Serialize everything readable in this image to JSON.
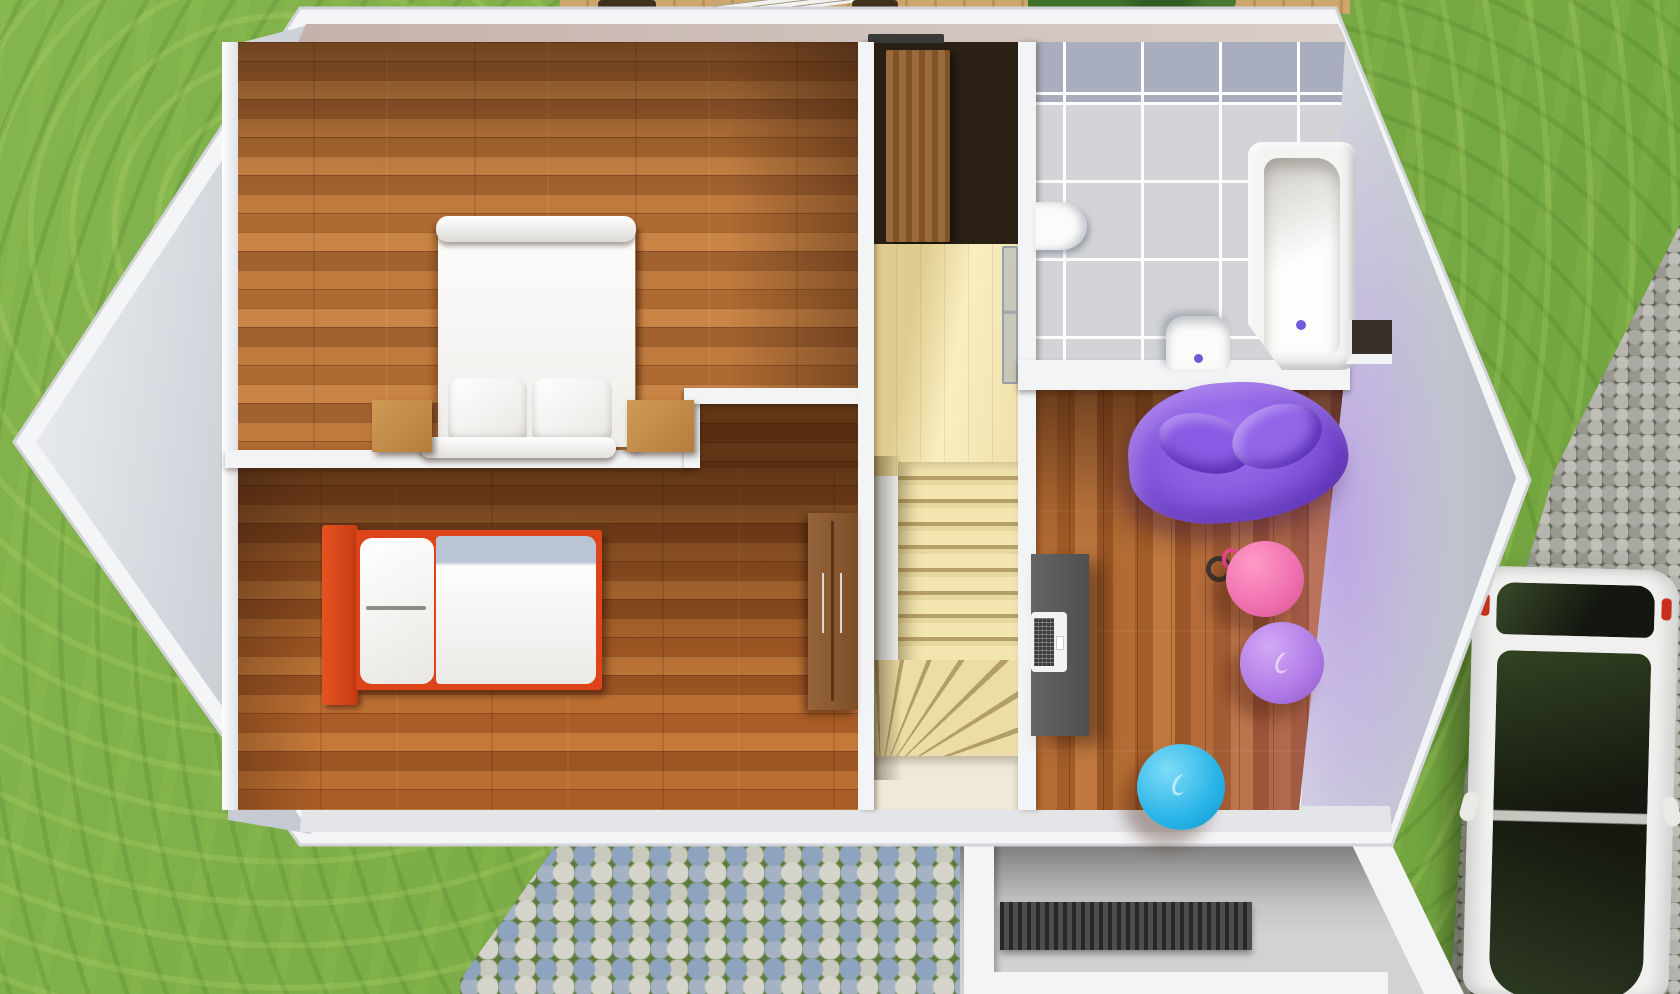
{
  "meta": {
    "title": "3D floor plan render — upper floor, top-down dollhouse view",
    "render_type": "architectural 3D floor plan",
    "visible_text": "none"
  },
  "palette": {
    "grass": "#7aae43",
    "wallWhite": "#f3f4f6",
    "wallFace": "#ccd0d7",
    "tile": "#d3d4d8",
    "tileBand": "#a8aebd",
    "accentPurple": "#6d5bd8",
    "bedRed": "#dd4419",
    "blanket": "#b9c4d4",
    "ballPink": "#ef6fae",
    "ballPurple": "#b07ae6",
    "ballBlue": "#29b4e8",
    "beanBag": "#8357dd",
    "carWhite": "#f0f0ee",
    "carGlass": "#15180f",
    "cobbleBlue": "#8ea3bd",
    "cobbleWhite": "#d6d5cb",
    "driveStone": "#a9a9a3",
    "porch": "#d2d2d0",
    "mat": "#3c3e40",
    "deckWood": "#c9a166",
    "stairWood": "#eddfa9"
  },
  "rooms": [
    {
      "id": "bedroom-master",
      "label": "Bedroom with double bed",
      "furniture": [
        "double bed with white duvet",
        "two pillows",
        "left nightstand",
        "right nightstand"
      ]
    },
    {
      "id": "bedroom-single",
      "label": "Bedroom with single bed",
      "furniture": [
        "single bed with red frame",
        "white pillow",
        "duvet with blue-grey band",
        "wooden dresser"
      ]
    },
    {
      "id": "stair-hall",
      "label": "Staircase hall",
      "furniture": [
        "winder staircase",
        "upper landing",
        "wardrobe closet",
        "glass partition"
      ]
    },
    {
      "id": "bathroom",
      "label": "Bathroom",
      "furniture": [
        "bathtub with purple drain",
        "toilet with purple button",
        "wash basin",
        "grey floor tiles"
      ]
    },
    {
      "id": "playroom",
      "label": "Office / play room",
      "furniture": [
        "dark grey desk",
        "open laptop",
        "purple bean bag",
        "pink gym ball with handle",
        "purple gym ball",
        "blue gym ball"
      ]
    }
  ],
  "exterior": {
    "lawn": "green lawn surrounding house",
    "deck": "wooden terrace with table and chairs (top edge)",
    "hedge": "green shrubs at top",
    "path": "blue and white cobblestone garden path",
    "porch": "entrance porch with ribbed doormat",
    "driveway": "grey cobblestone driveway",
    "car": "white car with dark panoramic roof, parked"
  }
}
